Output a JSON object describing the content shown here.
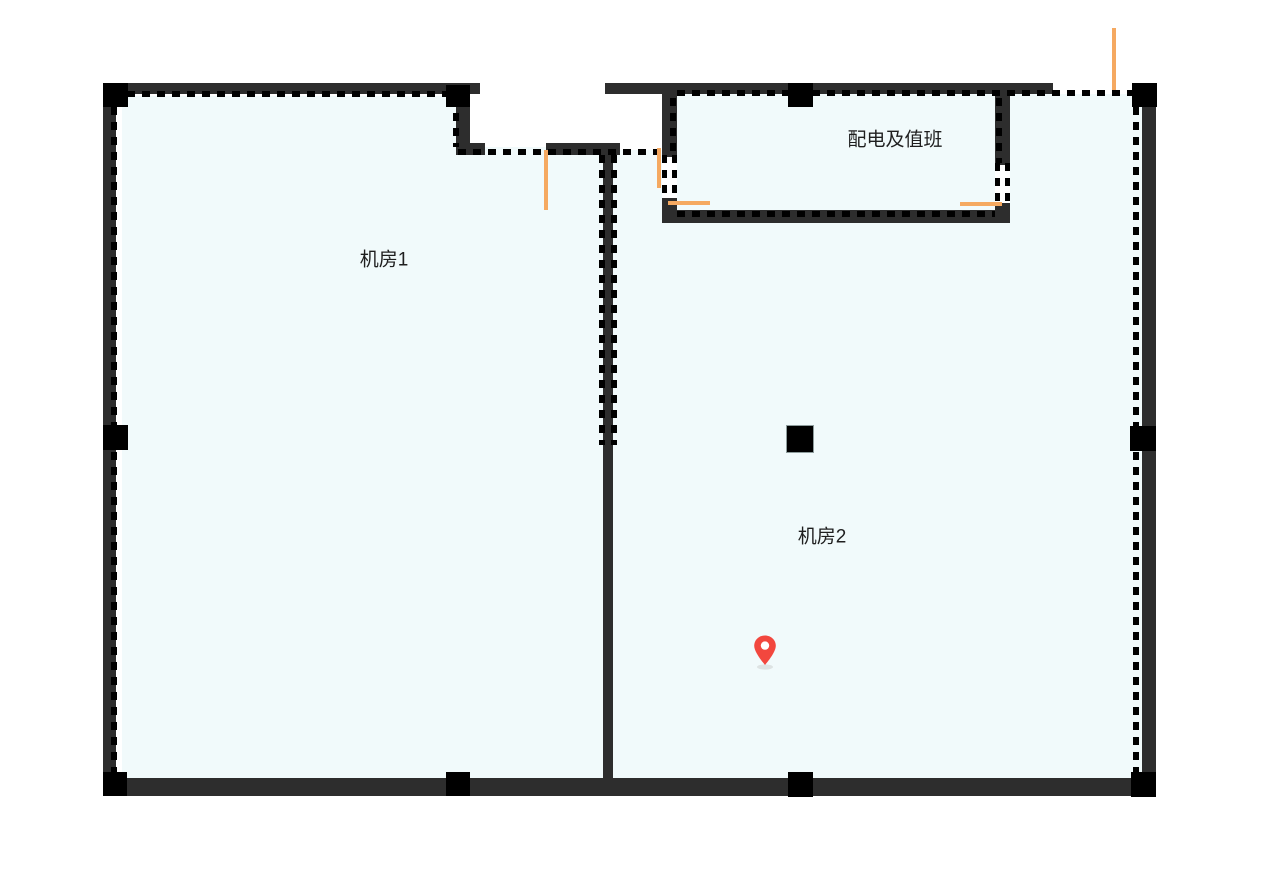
{
  "colors": {
    "wall": "#2d2d2d",
    "pillar": "#000000",
    "dash": "#000000",
    "floor": "#f1fafb",
    "door": "#f5a961",
    "pin": "#f2473e",
    "text": "#1f1f1f",
    "background": "#ffffff"
  },
  "rooms": [
    {
      "id": "machine-room-1",
      "label": "机房1"
    },
    {
      "id": "machine-room-2",
      "label": "机房2"
    },
    {
      "id": "power-duty-room",
      "label": "配电及值班"
    }
  ],
  "marker": {
    "name": "location-pin",
    "color": "#f2473e"
  }
}
